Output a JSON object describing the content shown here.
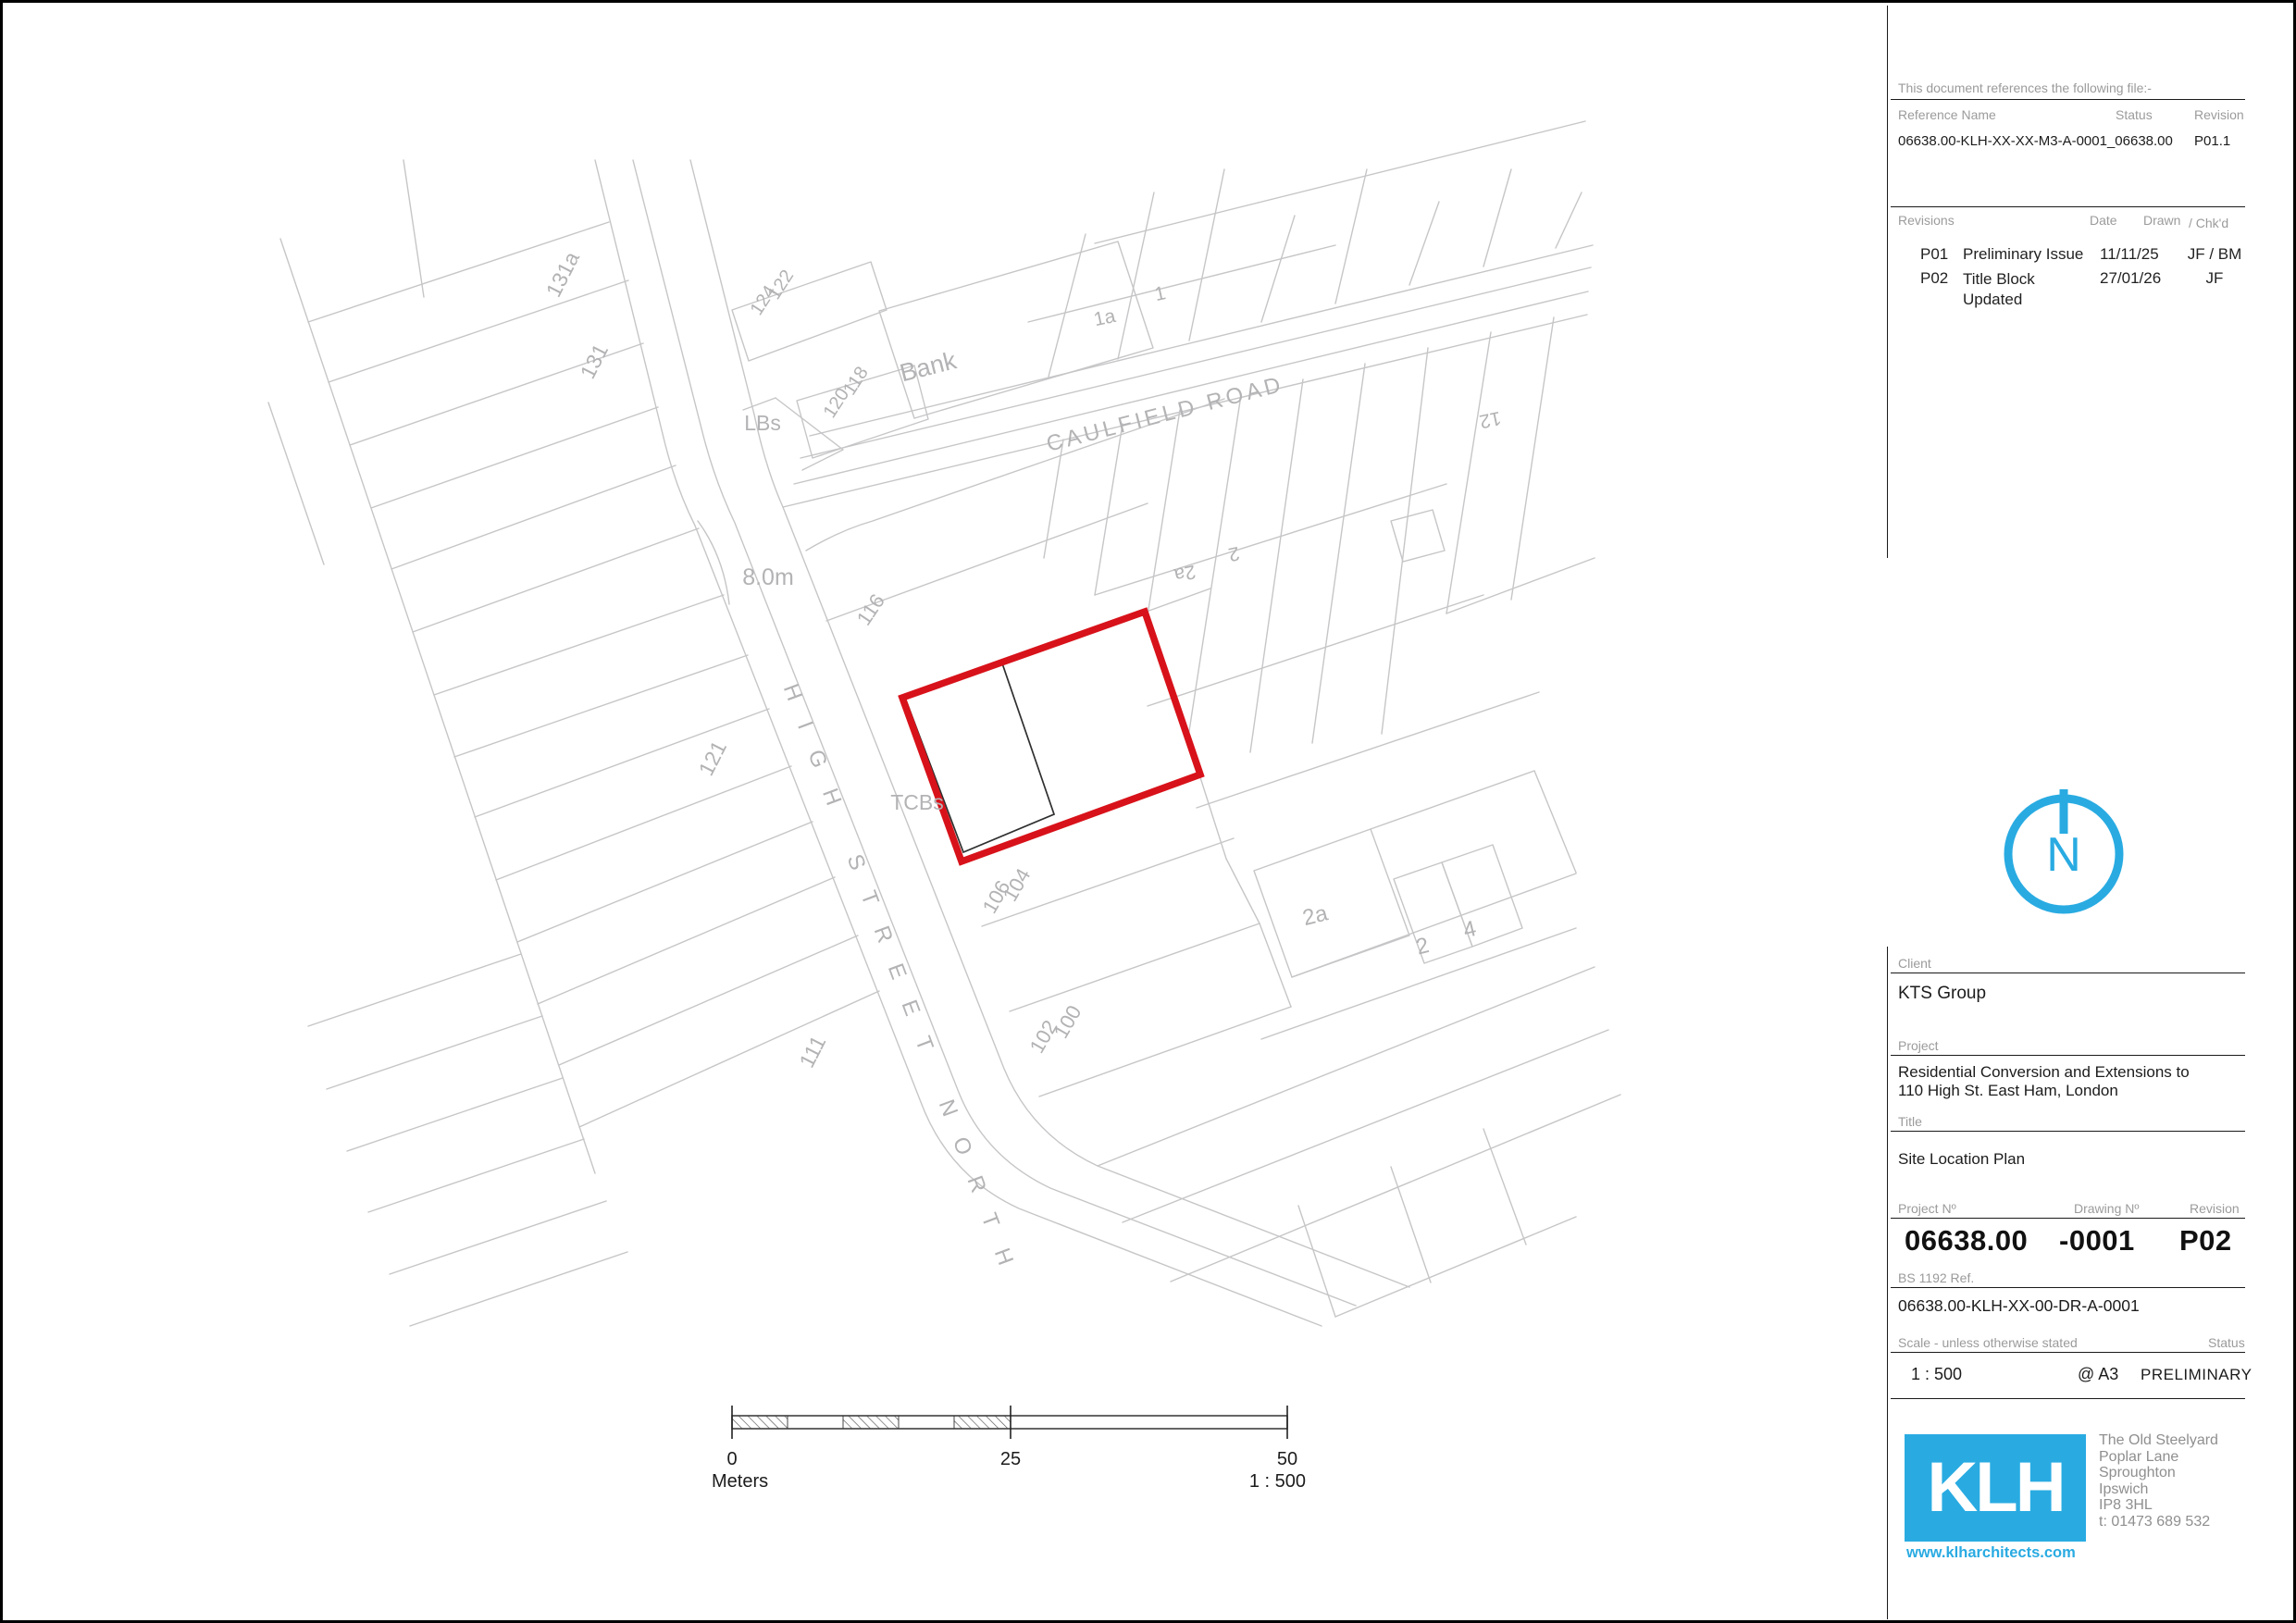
{
  "colors": {
    "accent_blue": "#29abe2",
    "boundary_red": "#d8121a",
    "map_line": "#c6c6c8",
    "map_label": "#b3b3b5",
    "building_black": "#2f2f2f",
    "rule_black": "#1a1a1a"
  },
  "reference_block": {
    "intro": "This document references the following file:-",
    "headers": {
      "name": "Reference Name",
      "status": "Status",
      "revision": "Revision"
    },
    "file": {
      "name": "06638.00-KLH-XX-XX-M3-A-0001_06638.00",
      "status": "",
      "revision": "P01.1"
    }
  },
  "revision_block": {
    "headers": {
      "revisions": "Revisions",
      "date": "Date",
      "drawn": "Drawn",
      "chkd": "/ Chk'd"
    },
    "rows": [
      {
        "id": "P01",
        "description": "Preliminary Issue",
        "date": "11/11/25",
        "by": "JF / BM"
      },
      {
        "id": "P02",
        "description": "Title Block Updated",
        "date": "27/01/26",
        "by": "JF"
      }
    ]
  },
  "north_arrow": {
    "letter": "N"
  },
  "title_block": {
    "client_label": "Client",
    "client": "KTS Group",
    "project_label": "Project",
    "project_line1": "Residential Conversion and Extensions to",
    "project_line2": "110 High St. East Ham, London",
    "title_label": "Title",
    "title": "Site Location Plan",
    "project_no_label": "Project Nº",
    "drawing_no_label": "Drawing Nº",
    "revision_label": "Revision",
    "project_no": "06638.00",
    "drawing_no": "-0001",
    "revision": "P02",
    "bs_ref_label": "BS 1192 Ref.",
    "bs_ref": "06638.00-KLH-XX-00-DR-A-0001",
    "scale_label": "Scale - unless otherwise stated",
    "status_label": "Status",
    "scale": "1 : 500",
    "sheet": "@ A3",
    "status": "PRELIMINARY"
  },
  "logo": {
    "text": "KLH",
    "website": "www.klharchitects.com",
    "address_lines": [
      "The Old Steelyard",
      "Poplar Lane",
      "Sproughton",
      "Ipswich",
      "IP8 3HL",
      "t: 01473 689 532"
    ]
  },
  "scale_bar": {
    "start": "0",
    "mid": "25",
    "end": "50",
    "unit": "Meters",
    "ratio": "1 : 500"
  },
  "map": {
    "labels": [
      {
        "t": "CAULFIELD ROAD"
      },
      {
        "t": "HIGH STREET NORTH"
      },
      {
        "t": "131a"
      },
      {
        "t": "131"
      },
      {
        "t": "122"
      },
      {
        "t": "124"
      },
      {
        "t": "118"
      },
      {
        "t": "120"
      },
      {
        "t": "Bank"
      },
      {
        "t": "LBs"
      },
      {
        "t": "8.0m"
      },
      {
        "t": "116"
      },
      {
        "t": "121"
      },
      {
        "t": "111"
      },
      {
        "t": "TCBs"
      },
      {
        "t": "104"
      },
      {
        "t": "106"
      },
      {
        "t": "100"
      },
      {
        "t": "102"
      },
      {
        "t": "1a"
      },
      {
        "t": "1"
      },
      {
        "t": "2a"
      },
      {
        "t": "2"
      },
      {
        "t": "12"
      },
      {
        "t": "2a"
      },
      {
        "t": "2"
      },
      {
        "t": "4"
      }
    ]
  }
}
